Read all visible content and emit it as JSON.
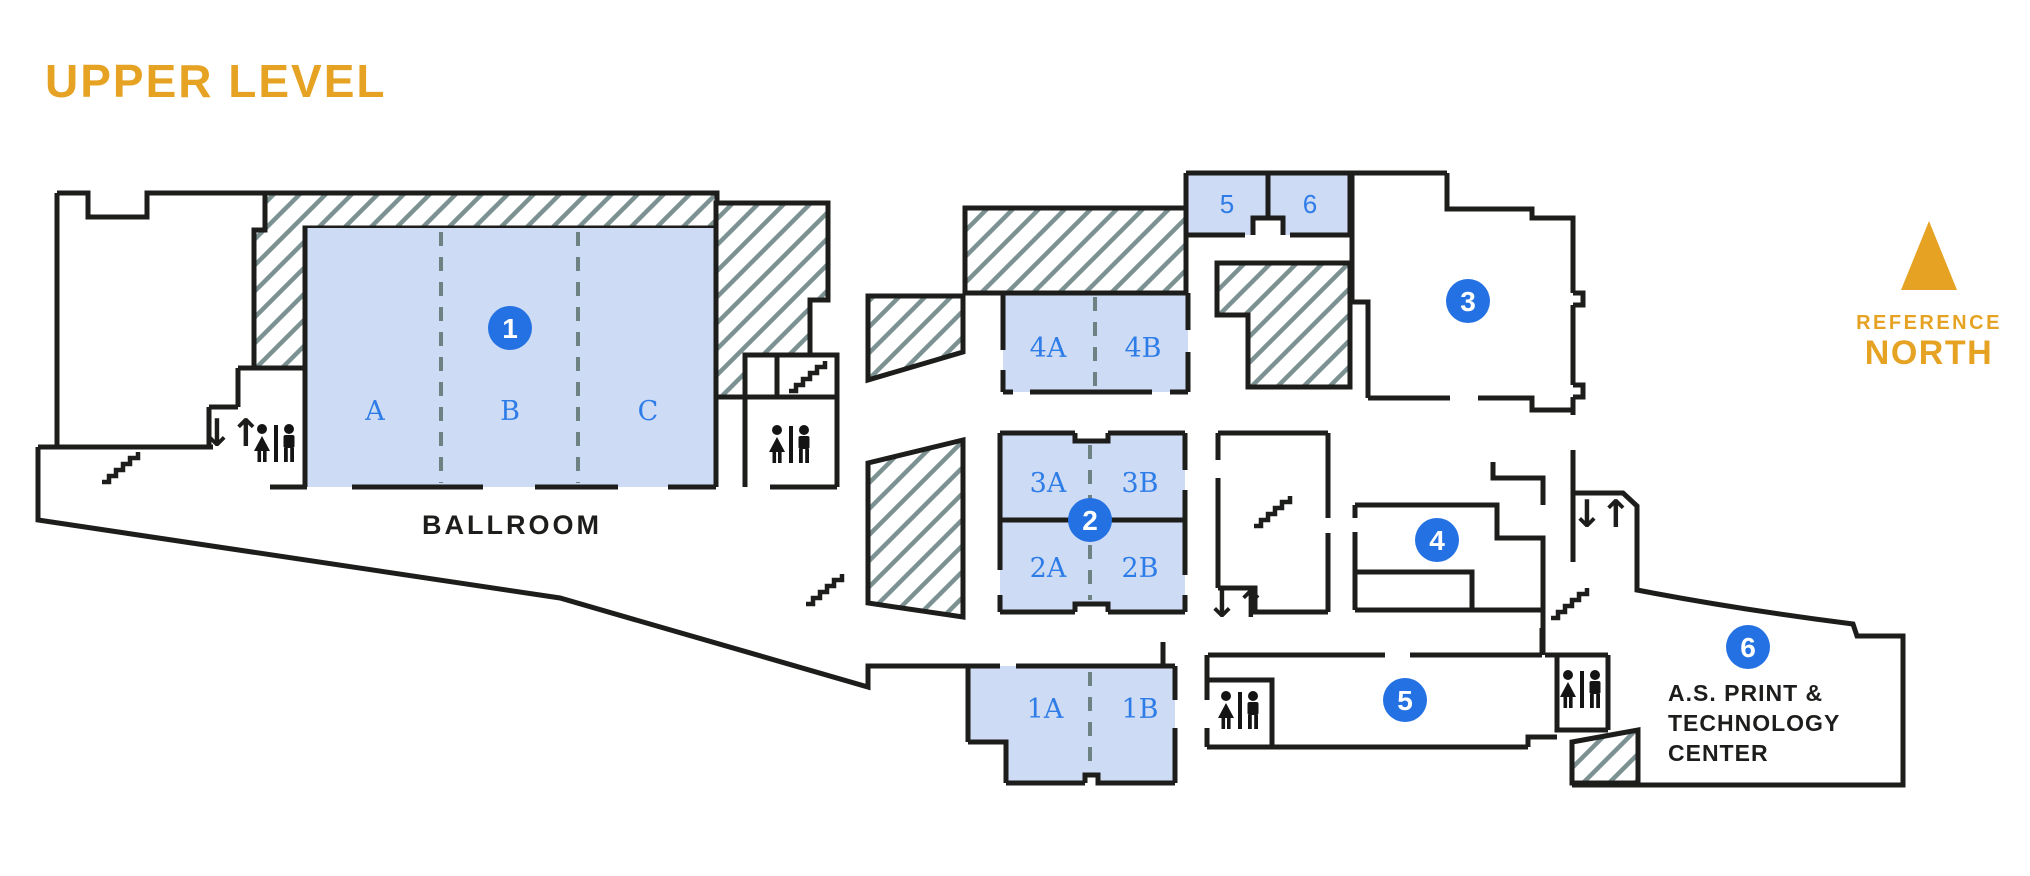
{
  "page_title": "UPPER LEVEL",
  "palette": {
    "accent_gold": "#e6a323",
    "room_fill": "#cddcf4",
    "label_blue": "#2e7ce8",
    "marker_blue": "#2471e3",
    "wall_black": "#1d1d1b",
    "hatch_gray": "#7b9192"
  },
  "compass": {
    "line1": "REFERENCE",
    "line2": "NORTH"
  },
  "ballroom": {
    "name": "BALLROOM",
    "sections": [
      "A",
      "B",
      "C"
    ]
  },
  "meeting_rooms": {
    "r1a": "1A",
    "r1b": "1B",
    "r2a": "2A",
    "r2b": "2B",
    "r3a": "3A",
    "r3b": "3B",
    "r4a": "4A",
    "r4b": "4B",
    "r5": "5",
    "r6": "6"
  },
  "markers": [
    {
      "label": "1"
    },
    {
      "label": "2"
    },
    {
      "label": "3"
    },
    {
      "label": "4"
    },
    {
      "label": "5"
    },
    {
      "label": "6"
    }
  ],
  "print_center": {
    "line1": "A.S. PRINT &",
    "line2": "TECHNOLOGY",
    "line3": "CENTER"
  },
  "icons": {
    "elevator": "↓↑"
  }
}
